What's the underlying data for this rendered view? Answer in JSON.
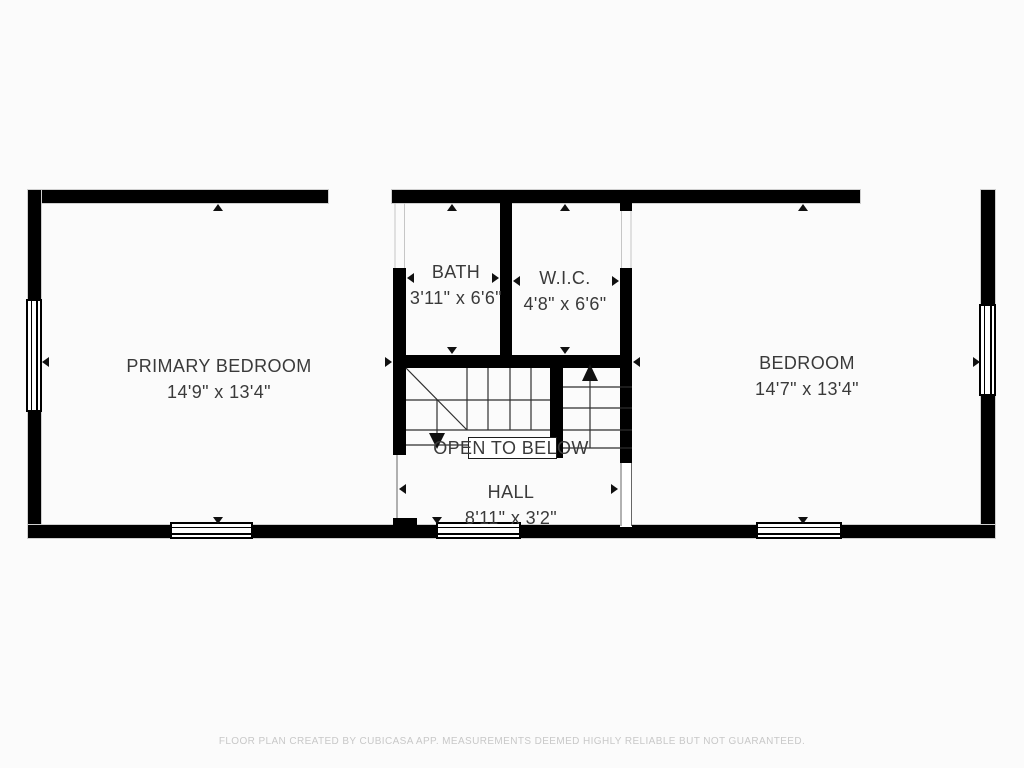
{
  "plan": {
    "wall_color": "#000000",
    "text_color": "#3a3a3a",
    "rooms": [
      {
        "id": "primary-bedroom",
        "label": "PRIMARY BEDROOM",
        "dimensions": "14'9\" x 13'4\""
      },
      {
        "id": "bath",
        "label": "BATH",
        "dimensions": "3'11\" x 6'6\""
      },
      {
        "id": "wic",
        "label": "W.I.C.",
        "dimensions": "4'8\" x 6'6\""
      },
      {
        "id": "bedroom",
        "label": "BEDROOM",
        "dimensions": "14'7\" x 13'4\""
      },
      {
        "id": "hall",
        "label": "HALL",
        "dimensions": "8'11\" x 3'2\""
      }
    ],
    "annotations": {
      "open_to_below": "OPEN TO BELOW"
    }
  },
  "footer": {
    "disclaimer": "FLOOR PLAN CREATED BY CUBICASA APP. MEASUREMENTS DEEMED HIGHLY RELIABLE BUT NOT GUARANTEED.",
    "color": "#c8c8c8"
  }
}
